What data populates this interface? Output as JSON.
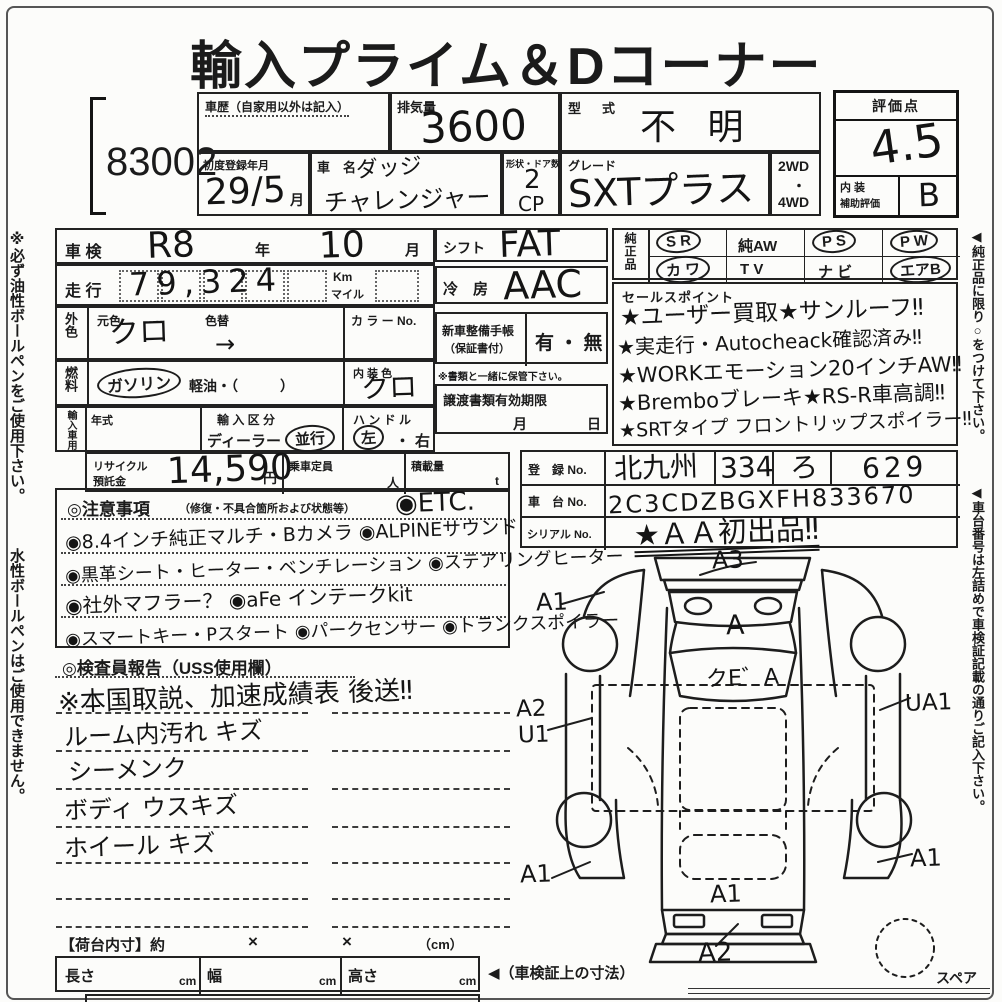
{
  "page": {
    "title": "輸入プライム＆Dコーナー",
    "lot_number": "83002"
  },
  "margins": {
    "left_note_1": "※必ず油性ボールペンをご使用下さい。",
    "left_note_2": "水性ボールペンはご使用できません。",
    "right_note_1": "◀純正品に限り○をつけて下さい。",
    "right_note_2": "◀車台番号は左詰めで車検証記載の通りご記入下さい。"
  },
  "header": {
    "car_history_label": "車歴（自家用以外は記入）",
    "displacement_label": "排気量",
    "displacement_value": "3600",
    "model_code_label": "型　式",
    "model_code_value": "不 明",
    "first_reg_label": "初度登録年月",
    "first_reg_value": "29/5",
    "first_reg_unit": "月",
    "car_name_label": "車　名",
    "car_name_line1": "ダッジ",
    "car_name_line2": "チャレンジャー",
    "body_label": "形状・ドア数",
    "body_value": "2",
    "body_suffix": "CP",
    "grade_label": "グレード",
    "grade_value": "SXTプラス",
    "drive_top": "2WD",
    "drive_mid": "・",
    "drive_bottom": "4WD",
    "score_label": "評価点",
    "score_value": "4.5",
    "interior_label_top": "内 装",
    "interior_label_bottom": "補助評価",
    "interior_value": "B"
  },
  "left_panel": {
    "shaken_label": "車 検",
    "shaken_era": "R8",
    "year_suffix": "年",
    "shaken_month": "10",
    "month_suffix": "月",
    "mileage_label": "走 行",
    "mileage_value": "79,324",
    "mileage_unit_top": "Km",
    "mileage_unit_bottom": "マイル",
    "ext_color_label": "外色",
    "base_color_label": "元色",
    "base_color_value": "クロ",
    "color_change_label": "色替",
    "color_change_value": "→",
    "color_no_label": "カ ラ ー No.",
    "fuel_label": "燃料",
    "fuel_gasoline": "ガソリン",
    "fuel_diesel": "軽油・（　　　）",
    "interior_color_label": "内 装 色",
    "interior_color_value": "クロ",
    "import_label": "輸入車用",
    "year_model_label": "年式",
    "import_class_label": "輸 入 区 分",
    "import_dealer": "ディーラー",
    "import_parallel": "並行",
    "handle_label": "ハ ン ド ル",
    "handle_left": "左",
    "handle_sep": "・",
    "handle_right": "右",
    "recycle_label_1": "リサイクル",
    "recycle_label_2": "預託金",
    "recycle_value": "14,590",
    "recycle_unit": "円",
    "capacity_label": "乗車定員",
    "capacity_unit": "人",
    "load_label": "積載量",
    "load_unit": "t"
  },
  "mid_panel": {
    "shift_label": "シフト",
    "shift_value": "FAT",
    "ac_label": "冷　房",
    "ac_value": "AAC",
    "service_book_label_1": "新車整備手帳",
    "service_book_label_2": "（保証書付）",
    "service_book_value": "有 ・ 無",
    "service_book_note": "※書類と一緒に保管下さい。",
    "transfer_label": "譲渡書類有効期限",
    "transfer_month": "月",
    "transfer_day": "日"
  },
  "genuine": {
    "label": "純正品",
    "row1": [
      {
        "label": "S R"
      },
      {
        "label": "純AW"
      },
      {
        "label": "P S"
      },
      {
        "label": "P W"
      }
    ],
    "row2": [
      {
        "label": "カ ワ"
      },
      {
        "label": "T V"
      },
      {
        "label": "ナ ビ"
      },
      {
        "label": "エアB"
      }
    ]
  },
  "sales_points": {
    "label": "セールスポイント",
    "lines": [
      "★ユーザー買取★サンルーフ‼",
      "★実走行・Autocheack確認済み‼",
      "★WORKエモーション20インチAW‼",
      "★Bremboブレーキ★RS-R車高調‼",
      "★SRTタイプ フロントリップスポイラー‼"
    ]
  },
  "registration": {
    "reg_label": "登　録 No.",
    "reg_area": "北九州",
    "reg_class": "334",
    "reg_kana": "ろ",
    "reg_number": "629",
    "chassis_label": "車　台 No.",
    "chassis_value": "2C3CDZBGXFH833670",
    "serial_label": "シリアル No.",
    "serial_value": "★ＡＡ初出品‼"
  },
  "cautions": {
    "header": "◎注意事項",
    "header_sub": "（修復・不具合箇所および状態等）",
    "first_item": "◉ETC.",
    "lines": [
      "◉8.4インチ純正マルチ・Bカメラ ◉ALPINEサウンド",
      "◉黒革シート・ヒーター・ベンチレーション ◉ステアリングヒーター",
      "◉社外マフラー？ ◉aFe インテークkit",
      "◉スマートキー・Pスタート ◉パークセンサー ◉トランクスポイラー"
    ]
  },
  "inspector": {
    "header": "◎検査員報告（USS使用欄）",
    "lines": [
      "※本国取説、加速成績表 後送‼",
      "ルーム内汚れ キズ",
      "シーメンク",
      "ボディ ウスキズ",
      "ホイール キズ"
    ]
  },
  "diagram": {
    "a3": "A3",
    "a1_front_left": "A1",
    "a_hood": "A",
    "windshield_mark": "クE゛A",
    "a2_side": "A2",
    "u1_side": "U1",
    "ua1_side": "UA1",
    "a1_rear_left": "A1",
    "a1_rear_right": "A1",
    "a1_trunk": "A1",
    "a2_rear": "A2",
    "spare_label": "スペア"
  },
  "bottom": {
    "cargo_label": "【荷台内寸】約",
    "cargo_x1": "×",
    "cargo_x2": "×",
    "cargo_unit": "（cm）",
    "length_label": "長さ",
    "width_label": "幅",
    "height_label": "高さ",
    "cm": "cm",
    "arrow_note": "◀（車検証上の寸法）"
  }
}
